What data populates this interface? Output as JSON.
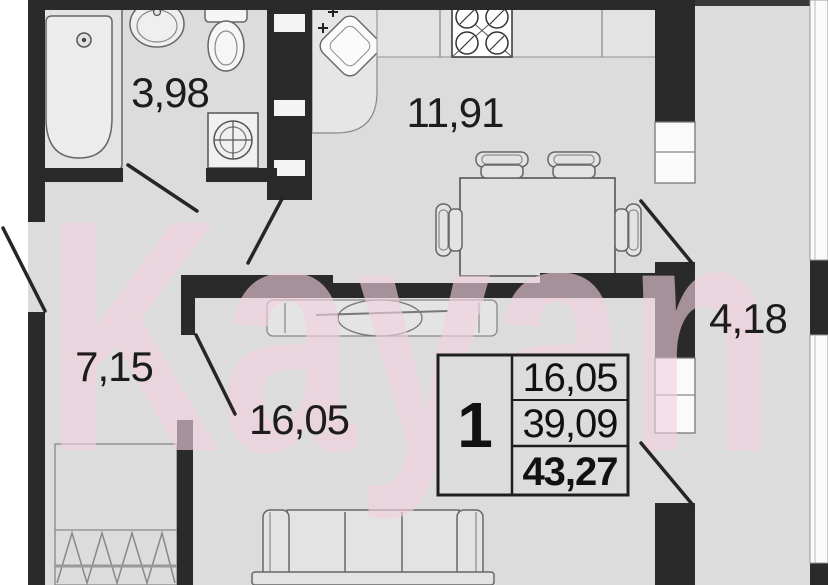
{
  "watermark": {
    "text": "Kayan"
  },
  "rooms": {
    "bathroom": {
      "label": "3,98"
    },
    "kitchen": {
      "label": "11,91"
    },
    "hallway": {
      "label": "7,15"
    },
    "living_room": {
      "label": "16,05"
    },
    "balcony": {
      "label": "4,18"
    }
  },
  "info_box": {
    "room_count": "1",
    "living_area": "16,05",
    "area_without_balcony": "39,09",
    "total_area": "43,27"
  },
  "colors": {
    "wall": "#2a2a2a",
    "floor": "#dcdcdc",
    "watermark_pink": "#f2cedd",
    "label_text": "#1c1c1c"
  }
}
